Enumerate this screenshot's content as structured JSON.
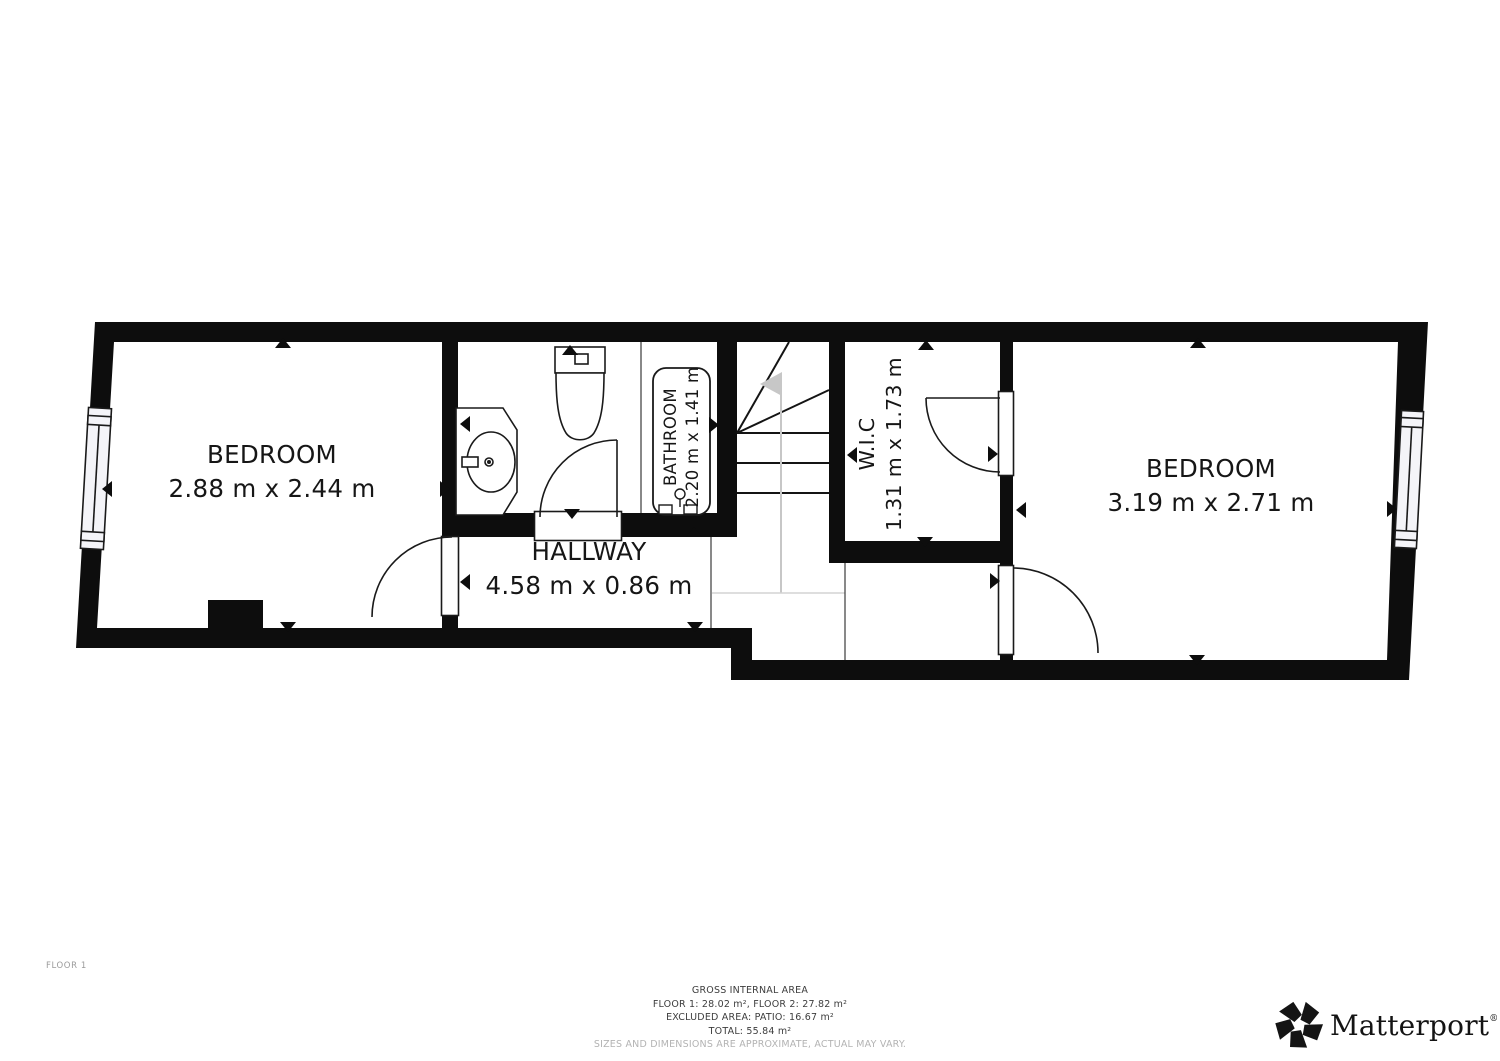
{
  "floor_tag": "FLOOR 1",
  "rooms": {
    "bedroom_left": {
      "name": "BEDROOM",
      "dims": "2.88 m x 2.44 m"
    },
    "bathroom": {
      "name": "BATHROOM",
      "dims": "2.20 m x 1.41 m"
    },
    "hallway": {
      "name": "HALLWAY",
      "dims": "4.58 m x 0.86 m"
    },
    "wic": {
      "name": "W.I.C",
      "dims": "1.31 m x 1.73 m"
    },
    "bedroom_right": {
      "name": "BEDROOM",
      "dims": "3.19 m x 2.71 m"
    }
  },
  "footer": {
    "line1": "GROSS INTERNAL AREA",
    "line2": "FLOOR 1: 28.02 m², FLOOR 2: 27.82 m²",
    "line3": "EXCLUDED AREA: PATIO: 16.67 m²",
    "line4": "TOTAL: 55.84 m²",
    "disclaimer": "SIZES AND DIMENSIONS ARE APPROXIMATE, ACTUAL MAY VARY."
  },
  "logo": {
    "brand": "Matterport",
    "registered": "®"
  },
  "colors": {
    "wall": "#0d0d0d",
    "line": "#1a1a1a",
    "walkline_gray": "#c7c7c7",
    "muted_text": "#9b9b9b"
  }
}
